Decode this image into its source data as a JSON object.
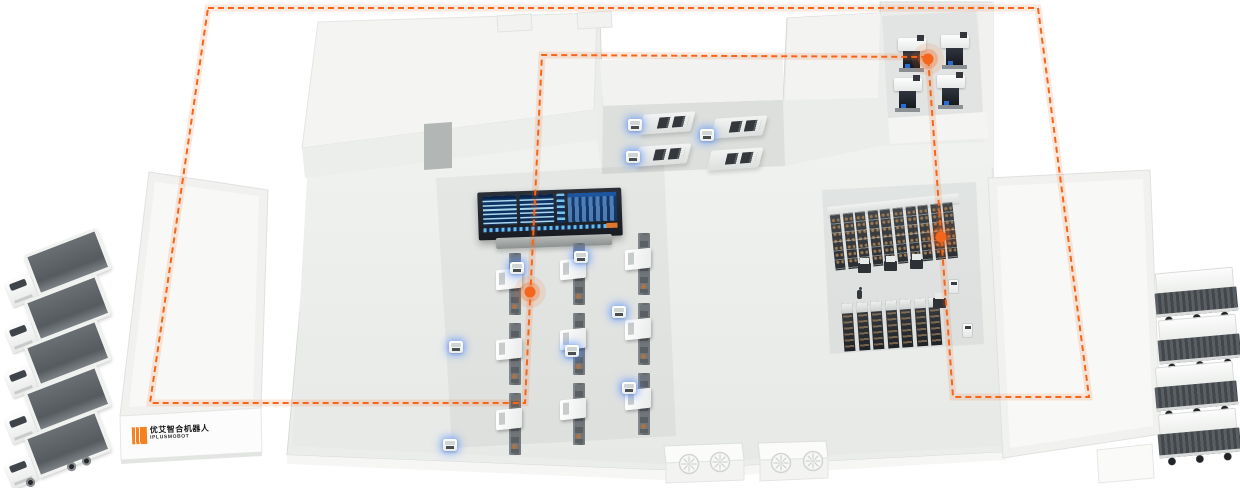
{
  "logo": {
    "zh": "优艾智合机器人",
    "en": "IPLUSMOBOT",
    "mark_color": "#f58220",
    "text_color": "#17171a"
  },
  "route": {
    "color": "#f4661b",
    "dash": [
      6,
      4
    ],
    "loop_points": [
      [
        208,
        8
      ],
      [
        1038,
        8
      ],
      [
        1089,
        397
      ],
      [
        953,
        397
      ],
      [
        928,
        57
      ],
      [
        542,
        55
      ],
      [
        525,
        403
      ],
      [
        150,
        403
      ]
    ],
    "glow_dots": [
      [
        928,
        59
      ],
      [
        941,
        237
      ],
      [
        530,
        292
      ]
    ]
  },
  "fleet": {
    "trucks_left_count": 5,
    "trailers_right_count": 4,
    "floor_agv_positions": [
      [
        510,
        262
      ],
      [
        574,
        251
      ],
      [
        612,
        306
      ],
      [
        449,
        341
      ],
      [
        565,
        345
      ],
      [
        622,
        382
      ],
      [
        443,
        439
      ]
    ],
    "dock_agv_positions": [
      [
        628,
        119
      ],
      [
        626,
        151
      ],
      [
        700,
        129
      ]
    ],
    "rack_shuttle_positions": [
      [
        858,
        263
      ],
      [
        884,
        261
      ],
      [
        910,
        259
      ],
      [
        933,
        298
      ]
    ],
    "worker_positions": [
      [
        857,
        287
      ]
    ],
    "service_robot_positions": [
      [
        948,
        279
      ],
      [
        962,
        323
      ]
    ]
  },
  "equipment": {
    "production_line": {
      "columns": 3,
      "machines_per_column": 3
    },
    "inbound_dock_machines": 4,
    "corner_test_machines": 4,
    "rack_bays_top": 10,
    "rack_units_bottom": 7,
    "hvac_fans": 4
  },
  "dashboard": {
    "frame": "#20252c",
    "panel": "#0d3263",
    "stripe": "#9fd4ef",
    "accent_orange": "#e0762a"
  },
  "palette": {
    "background": "#ffffff",
    "building": "#ebedeb",
    "building_edge": "#d7dad7",
    "roof": "#f4f5f3",
    "recess_floor": "#dcdfdc",
    "glow_blue": "#6096ff",
    "route_orange": "#f4661b"
  }
}
